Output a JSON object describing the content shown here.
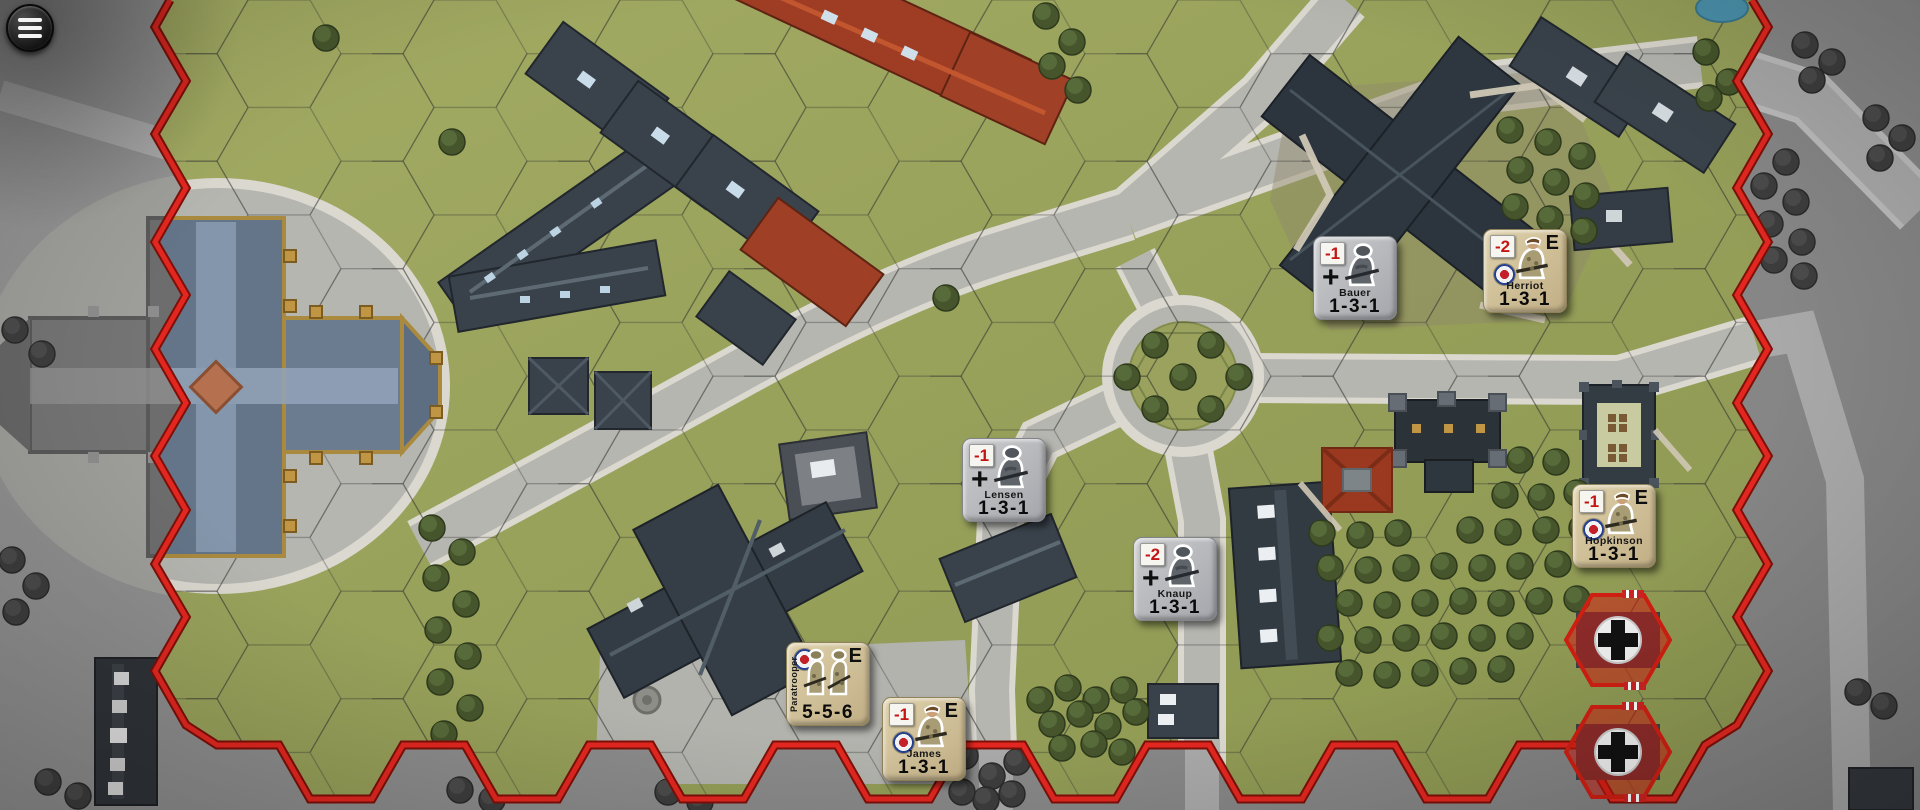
{
  "app": {
    "type": "hex-wargame-map"
  },
  "menu": {
    "name": "menu",
    "icon": "hamburger-icon"
  },
  "colors": {
    "out_of_play_gray": "#8d8d8d",
    "grass_green": "#9aa35e",
    "road_gray": "#b6b6b1",
    "boundary_red": "#dd2318",
    "german_counter": "#b9babe",
    "british_counter": "#d3c49d",
    "badge_red": "#c41414",
    "objective_red": "#cf1f12"
  },
  "units": [
    {
      "id": "bauer",
      "name": "Bauer",
      "stats": "1-3-1",
      "faction": "german",
      "badge": "-1",
      "symbol": "plus",
      "elite": "",
      "x": 1313,
      "y": 236
    },
    {
      "id": "herriot",
      "name": "Herriot",
      "stats": "1-3-1",
      "faction": "british",
      "badge": "-2",
      "symbol": "roundel",
      "elite": "E",
      "x": 1483,
      "y": 229
    },
    {
      "id": "lensen",
      "name": "Lensen",
      "stats": "1-3-1",
      "faction": "german",
      "badge": "-1",
      "symbol": "plus",
      "elite": "",
      "x": 962,
      "y": 438
    },
    {
      "id": "knaup",
      "name": "Knaup",
      "stats": "1-3-1",
      "faction": "german",
      "badge": "-2",
      "symbol": "plus",
      "elite": "",
      "x": 1133,
      "y": 537
    },
    {
      "id": "hopkinson",
      "name": "Hopkinson",
      "stats": "1-3-1",
      "faction": "british",
      "badge": "-1",
      "symbol": "roundel",
      "elite": "E",
      "x": 1572,
      "y": 484
    },
    {
      "id": "paratrooper",
      "name": "Paratrooper",
      "stats": "5-5-6",
      "faction": "british",
      "badge": "",
      "symbol": "roundel",
      "elite": "E",
      "x": 786,
      "y": 642,
      "layout": "vertical-name",
      "figures": 2
    },
    {
      "id": "james",
      "name": "James",
      "stats": "1-3-1",
      "faction": "british",
      "badge": "-1",
      "symbol": "roundel",
      "elite": "E",
      "x": 882,
      "y": 697
    }
  ],
  "objectives": [
    {
      "id": "objective-german-1",
      "marking": "balkenkreuz",
      "x": 1618,
      "y": 640
    },
    {
      "id": "objective-german-2",
      "marking": "balkenkreuz",
      "x": 1618,
      "y": 752
    }
  ]
}
